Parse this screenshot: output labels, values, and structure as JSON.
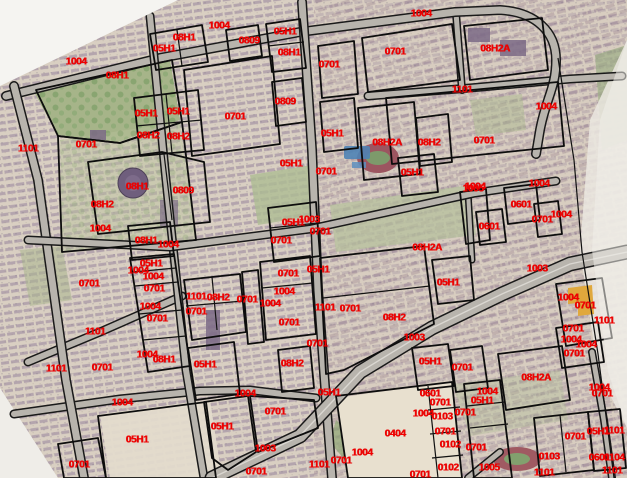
{
  "map": {
    "kind": "cadastral-parcel-overlay-on-satellite",
    "colors": {
      "label": "#f20000",
      "boundary": "#0d0d0d",
      "road_fill": "#b8b4ad",
      "road_casing": "#1a1a1a",
      "background": "#d8cec1"
    },
    "labels": [
      {
        "text": "1004",
        "x": 76,
        "y": 62
      },
      {
        "text": "1004",
        "x": 219,
        "y": 26
      },
      {
        "text": "1004",
        "x": 421,
        "y": 14
      },
      {
        "text": "08H1",
        "x": 184,
        "y": 38
      },
      {
        "text": "05H1",
        "x": 164,
        "y": 49
      },
      {
        "text": "05H1",
        "x": 285,
        "y": 32
      },
      {
        "text": "0809",
        "x": 249,
        "y": 41
      },
      {
        "text": "08H1",
        "x": 289,
        "y": 53
      },
      {
        "text": "08H2A",
        "x": 495,
        "y": 49
      },
      {
        "text": "0701",
        "x": 395,
        "y": 52
      },
      {
        "text": "0701",
        "x": 329,
        "y": 65
      },
      {
        "text": "08H1",
        "x": 117,
        "y": 76
      },
      {
        "text": "1101",
        "x": 462,
        "y": 90
      },
      {
        "text": "0809",
        "x": 285,
        "y": 102
      },
      {
        "text": "1004",
        "x": 546,
        "y": 107
      },
      {
        "text": "05H1",
        "x": 178,
        "y": 112
      },
      {
        "text": "05H1",
        "x": 146,
        "y": 114
      },
      {
        "text": "0701",
        "x": 235,
        "y": 117
      },
      {
        "text": "05H1",
        "x": 332,
        "y": 134
      },
      {
        "text": "08H2",
        "x": 148,
        "y": 136
      },
      {
        "text": "08H2",
        "x": 178,
        "y": 137
      },
      {
        "text": "0701",
        "x": 484,
        "y": 141
      },
      {
        "text": "08H2A",
        "x": 387,
        "y": 143
      },
      {
        "text": "08H2",
        "x": 429,
        "y": 143
      },
      {
        "text": "0701",
        "x": 86,
        "y": 145
      },
      {
        "text": "1101",
        "x": 28,
        "y": 149
      },
      {
        "text": "05H1",
        "x": 291,
        "y": 164
      },
      {
        "text": "0701",
        "x": 326,
        "y": 172
      },
      {
        "text": "05H1",
        "x": 412,
        "y": 173
      },
      {
        "text": "1004",
        "x": 475,
        "y": 187
      },
      {
        "text": "08H1",
        "x": 137,
        "y": 187
      },
      {
        "text": "1005",
        "x": 473,
        "y": 189
      },
      {
        "text": "0809",
        "x": 183,
        "y": 191
      },
      {
        "text": "1004",
        "x": 539,
        "y": 184
      },
      {
        "text": "08H2",
        "x": 102,
        "y": 205
      },
      {
        "text": "0601",
        "x": 521,
        "y": 205
      },
      {
        "text": "1004",
        "x": 561,
        "y": 215
      },
      {
        "text": "1003",
        "x": 309,
        "y": 220
      },
      {
        "text": "0701",
        "x": 542,
        "y": 220
      },
      {
        "text": "05H1",
        "x": 293,
        "y": 223
      },
      {
        "text": "0601",
        "x": 489,
        "y": 227
      },
      {
        "text": "1004",
        "x": 100,
        "y": 229
      },
      {
        "text": "0701",
        "x": 320,
        "y": 232
      },
      {
        "text": "08H1",
        "x": 146,
        "y": 241
      },
      {
        "text": "0701",
        "x": 281,
        "y": 241
      },
      {
        "text": "1004",
        "x": 168,
        "y": 245
      },
      {
        "text": "08H2A",
        "x": 427,
        "y": 248
      },
      {
        "text": "05H1",
        "x": 151,
        "y": 264
      },
      {
        "text": "1003",
        "x": 537,
        "y": 269
      },
      {
        "text": "05H1",
        "x": 318,
        "y": 270
      },
      {
        "text": "1004",
        "x": 138,
        "y": 271
      },
      {
        "text": "0701",
        "x": 288,
        "y": 274
      },
      {
        "text": "1004",
        "x": 153,
        "y": 277
      },
      {
        "text": "05H1",
        "x": 448,
        "y": 283
      },
      {
        "text": "0701",
        "x": 89,
        "y": 284
      },
      {
        "text": "0701",
        "x": 154,
        "y": 289
      },
      {
        "text": "1004",
        "x": 284,
        "y": 292
      },
      {
        "text": "1101",
        "x": 196,
        "y": 297
      },
      {
        "text": "08H2",
        "x": 218,
        "y": 298
      },
      {
        "text": "1004",
        "x": 568,
        "y": 298
      },
      {
        "text": "0701",
        "x": 585,
        "y": 306
      },
      {
        "text": "1004",
        "x": 150,
        "y": 307
      },
      {
        "text": "1101",
        "x": 325,
        "y": 308
      },
      {
        "text": "0701",
        "x": 350,
        "y": 309
      },
      {
        "text": "0701",
        "x": 196,
        "y": 312
      },
      {
        "text": "0701",
        "x": 247,
        "y": 300
      },
      {
        "text": "1004",
        "x": 270,
        "y": 304
      },
      {
        "text": "08H2",
        "x": 394,
        "y": 318
      },
      {
        "text": "0701",
        "x": 157,
        "y": 319
      },
      {
        "text": "1101",
        "x": 604,
        "y": 321
      },
      {
        "text": "0701",
        "x": 289,
        "y": 323
      },
      {
        "text": "0701",
        "x": 573,
        "y": 329
      },
      {
        "text": "1101",
        "x": 95,
        "y": 332
      },
      {
        "text": "1003",
        "x": 414,
        "y": 338
      },
      {
        "text": "1004",
        "x": 571,
        "y": 340
      },
      {
        "text": "0701",
        "x": 317,
        "y": 344
      },
      {
        "text": "1004",
        "x": 586,
        "y": 345
      },
      {
        "text": "0701",
        "x": 574,
        "y": 354
      },
      {
        "text": "1004",
        "x": 147,
        "y": 355
      },
      {
        "text": "08H1",
        "x": 164,
        "y": 360
      },
      {
        "text": "05H1",
        "x": 430,
        "y": 362
      },
      {
        "text": "05H1",
        "x": 205,
        "y": 365
      },
      {
        "text": "08H2",
        "x": 292,
        "y": 364
      },
      {
        "text": "0701",
        "x": 462,
        "y": 368
      },
      {
        "text": "1101",
        "x": 56,
        "y": 369
      },
      {
        "text": "0701",
        "x": 102,
        "y": 368
      },
      {
        "text": "08H2A",
        "x": 536,
        "y": 378
      },
      {
        "text": "1004",
        "x": 599,
        "y": 388
      },
      {
        "text": "1004",
        "x": 487,
        "y": 392
      },
      {
        "text": "0701",
        "x": 602,
        "y": 394
      },
      {
        "text": "05H1",
        "x": 329,
        "y": 393
      },
      {
        "text": "0601",
        "x": 430,
        "y": 394
      },
      {
        "text": "1004",
        "x": 245,
        "y": 394
      },
      {
        "text": "05H1",
        "x": 482,
        "y": 401
      },
      {
        "text": "0701",
        "x": 440,
        "y": 403
      },
      {
        "text": "1004",
        "x": 122,
        "y": 403
      },
      {
        "text": "0701",
        "x": 275,
        "y": 412
      },
      {
        "text": "0701",
        "x": 465,
        "y": 413
      },
      {
        "text": "1004",
        "x": 423,
        "y": 414
      },
      {
        "text": "0103",
        "x": 442,
        "y": 417
      },
      {
        "text": "05H1",
        "x": 222,
        "y": 427
      },
      {
        "text": "1101",
        "x": 614,
        "y": 431
      },
      {
        "text": "05H1",
        "x": 598,
        "y": 432
      },
      {
        "text": "0701",
        "x": 445,
        "y": 432
      },
      {
        "text": "0404",
        "x": 395,
        "y": 434
      },
      {
        "text": "0701",
        "x": 575,
        "y": 437
      },
      {
        "text": "05H1",
        "x": 137,
        "y": 440
      },
      {
        "text": "0102",
        "x": 450,
        "y": 445
      },
      {
        "text": "0701",
        "x": 476,
        "y": 448
      },
      {
        "text": "1003",
        "x": 265,
        "y": 449
      },
      {
        "text": "1004",
        "x": 362,
        "y": 453
      },
      {
        "text": "0103",
        "x": 549,
        "y": 457
      },
      {
        "text": "0601",
        "x": 599,
        "y": 458
      },
      {
        "text": "0104",
        "x": 614,
        "y": 458
      },
      {
        "text": "0701",
        "x": 341,
        "y": 461
      },
      {
        "text": "1101",
        "x": 319,
        "y": 465
      },
      {
        "text": "0701",
        "x": 79,
        "y": 465
      },
      {
        "text": "0102",
        "x": 448,
        "y": 468
      },
      {
        "text": "1005",
        "x": 489,
        "y": 468
      },
      {
        "text": "1101",
        "x": 544,
        "y": 473
      },
      {
        "text": "1101",
        "x": 612,
        "y": 471
      },
      {
        "text": "0701",
        "x": 256,
        "y": 472
      },
      {
        "text": "0701",
        "x": 420,
        "y": 475
      }
    ]
  }
}
